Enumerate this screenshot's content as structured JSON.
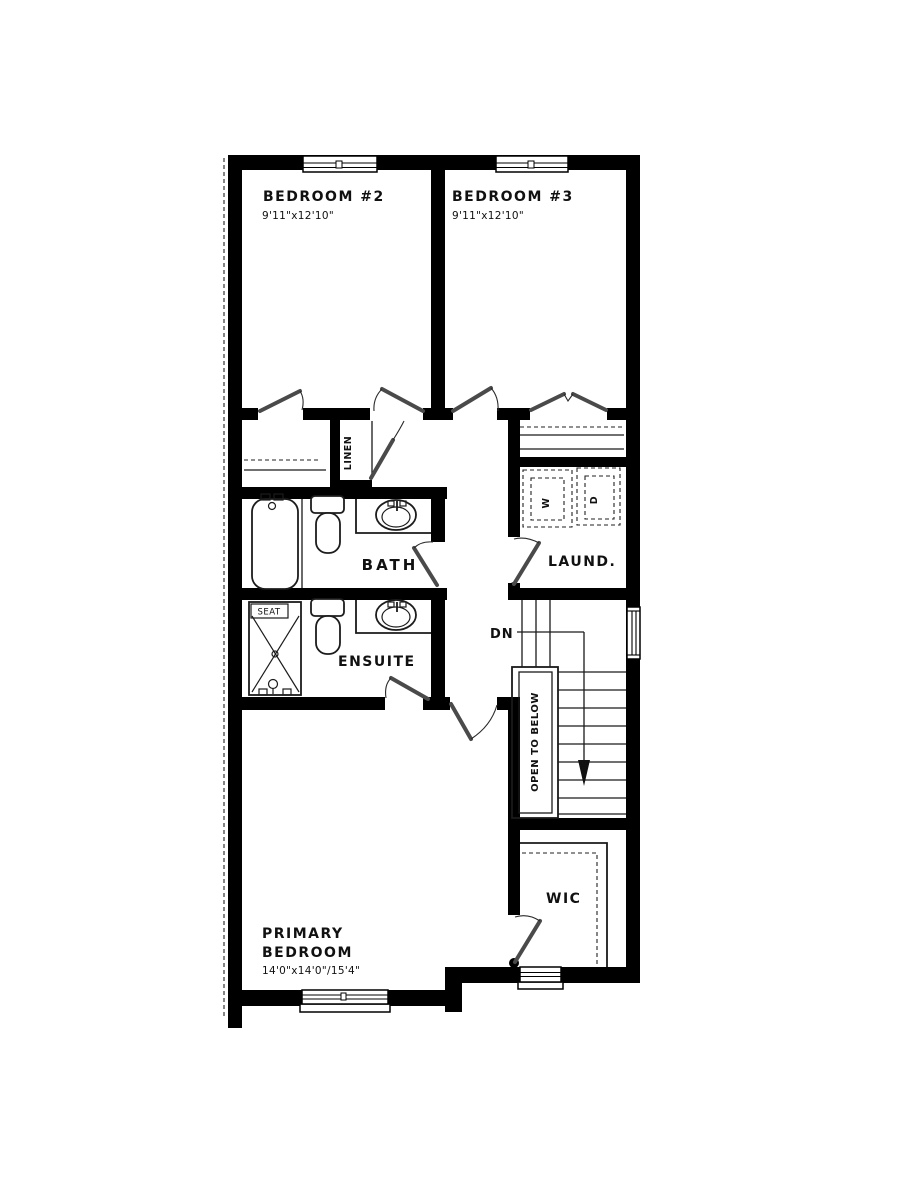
{
  "floorplan": {
    "rooms": {
      "bedroom2": {
        "name": "BEDROOM #2",
        "dims": "9'11\"x12'10\""
      },
      "bedroom3": {
        "name": "BEDROOM #3",
        "dims": "9'11\"x12'10\""
      },
      "bath": {
        "name": "BATH"
      },
      "ensuite": {
        "name": "ENSUITE"
      },
      "laundry": {
        "name": "LAUND."
      },
      "linen": {
        "name": "LINEN"
      },
      "wic": {
        "name": "WIC"
      },
      "primary_bedroom": {
        "name_line1": "PRIMARY",
        "name_line2": "BEDROOM",
        "dims": "14'0\"x14'0\"/15'4\""
      },
      "stairs": {
        "open_label": "OPEN TO BELOW",
        "down_label": "DN"
      }
    },
    "fixtures": {
      "washer_label": "W",
      "dryer_label": "D",
      "shower_seat_label": "SEAT"
    },
    "colors": {
      "wall": "#000000",
      "background": "#ffffff",
      "door_leaf": "#4a4a4a",
      "line": "#1a1a1a"
    }
  }
}
